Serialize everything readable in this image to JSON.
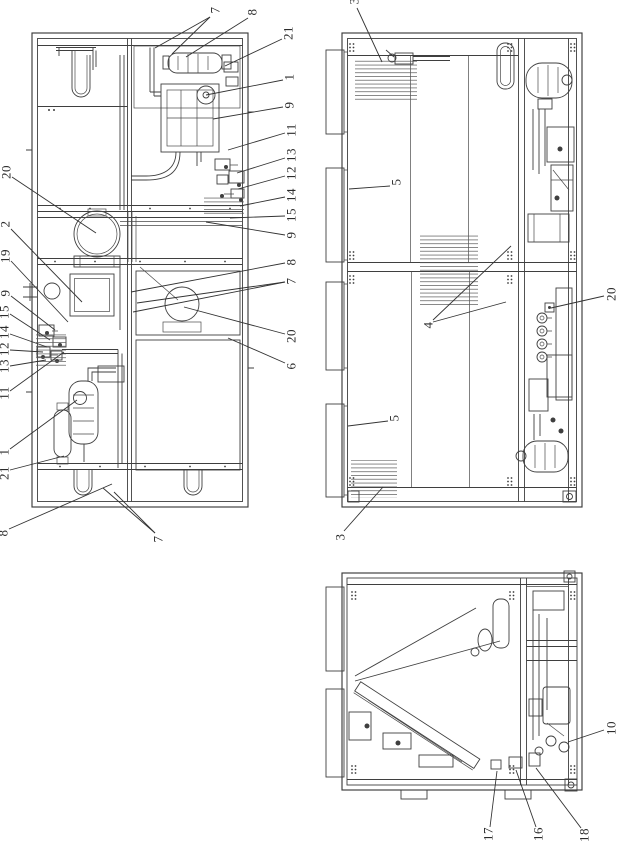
{
  "page": {
    "background": "#ffffff",
    "line_color": "#3f3f3f",
    "leader_color": "#333333",
    "label_color": "#2b2b2b",
    "label_rotation_deg": -90
  },
  "figures": [
    {
      "id": "plan-view",
      "name": "unit-top-plan-view",
      "callouts": [
        {
          "label": "7",
          "x": 215,
          "y": 10,
          "leaders": [
            [
              210,
              17,
              155,
              48
            ],
            [
              210,
              17,
              172,
              54
            ]
          ]
        },
        {
          "label": "8",
          "x": 252,
          "y": 12,
          "leaders": [
            [
              248,
              18,
              186,
              57
            ]
          ]
        },
        {
          "label": "21",
          "x": 288,
          "y": 33,
          "leaders": [
            [
              282,
              39,
              225,
              66
            ]
          ]
        },
        {
          "label": "1",
          "x": 289,
          "y": 77,
          "leaders": [
            [
              283,
              80,
              206,
              95
            ]
          ]
        },
        {
          "label": "9",
          "x": 289,
          "y": 105,
          "leaders": [
            [
              283,
              107,
              213,
              119
            ]
          ]
        },
        {
          "label": "11",
          "x": 291,
          "y": 130,
          "leaders": [
            [
              285,
              133,
              228,
              150
            ]
          ]
        },
        {
          "label": "13",
          "x": 291,
          "y": 155,
          "leaders": [
            [
              285,
              158,
              237,
              173
            ]
          ]
        },
        {
          "label": "12",
          "x": 291,
          "y": 173,
          "leaders": [
            [
              285,
              176,
              238,
              189
            ]
          ]
        },
        {
          "label": "14",
          "x": 291,
          "y": 195,
          "leaders": [
            [
              285,
              197,
              240,
              206
            ]
          ]
        },
        {
          "label": "15",
          "x": 291,
          "y": 215,
          "leaders": [
            [
              285,
              216,
              230,
              218
            ]
          ]
        },
        {
          "label": "9",
          "x": 291,
          "y": 235,
          "leaders": [
            [
              285,
              235,
              206,
              222
            ]
          ]
        },
        {
          "label": "8",
          "x": 291,
          "y": 262,
          "leaders": [
            [
              285,
              263,
              131,
              292
            ]
          ]
        },
        {
          "label": "7",
          "x": 291,
          "y": 281,
          "leaders": [
            [
              285,
              282,
              137,
              303
            ],
            [
              285,
              282,
              133,
              312
            ]
          ]
        },
        {
          "label": "20",
          "x": 291,
          "y": 336,
          "leaders": [
            [
              285,
              334,
              184,
              307
            ]
          ]
        },
        {
          "label": "6",
          "x": 291,
          "y": 366,
          "leaders": [
            [
              285,
              363,
              228,
              338
            ]
          ]
        },
        {
          "label": "20",
          "x": 6,
          "y": 172,
          "leaders": [
            [
              12,
              177,
              96,
              233
            ]
          ]
        },
        {
          "label": "2",
          "x": 5,
          "y": 224,
          "leaders": [
            [
              11,
              229,
              82,
              302
            ]
          ]
        },
        {
          "label": "19",
          "x": 5,
          "y": 256,
          "leaders": [
            [
              11,
              261,
              68,
              322
            ]
          ]
        },
        {
          "label": "9",
          "x": 5,
          "y": 293,
          "leaders": [
            [
              11,
              296,
              55,
              330
            ]
          ]
        },
        {
          "label": "15",
          "x": 4,
          "y": 312,
          "leaders": [
            [
              10,
              314,
              50,
              340
            ]
          ]
        },
        {
          "label": "14",
          "x": 4,
          "y": 332,
          "leaders": [
            [
              10,
              334,
              47,
              347
            ]
          ]
        },
        {
          "label": "12",
          "x": 4,
          "y": 349,
          "leaders": [
            [
              10,
              350,
              43,
              352
            ]
          ]
        },
        {
          "label": "13",
          "x": 4,
          "y": 366,
          "leaders": [
            [
              10,
              366,
              46,
              360
            ]
          ]
        },
        {
          "label": "11",
          "x": 4,
          "y": 393,
          "leaders": [
            [
              10,
              391,
              64,
              352
            ]
          ]
        },
        {
          "label": "1",
          "x": 4,
          "y": 452,
          "leaders": [
            [
              10,
              449,
              77,
              400
            ]
          ]
        },
        {
          "label": "21",
          "x": 4,
          "y": 473,
          "leaders": [
            [
              10,
              470,
              64,
              456
            ]
          ]
        },
        {
          "label": "8",
          "x": 3,
          "y": 533,
          "leaders": [
            [
              9,
              529,
              112,
              484
            ]
          ]
        },
        {
          "label": "7",
          "x": 158,
          "y": 539,
          "leaders": [
            [
              155,
              533,
              103,
              488
            ],
            [
              155,
              533,
              114,
              492
            ]
          ]
        }
      ]
    },
    {
      "id": "front-view",
      "name": "unit-front-view",
      "callouts": [
        {
          "label": "3",
          "x": 354,
          "y": 1,
          "leaders": [
            [
              357,
              8,
              382,
              62
            ]
          ]
        },
        {
          "label": "5",
          "x": 396,
          "y": 182,
          "leaders": [
            [
              390,
              186,
              349,
              189
            ]
          ]
        },
        {
          "label": "4",
          "x": 428,
          "y": 325,
          "leaders": [
            [
              433,
              320,
              511,
              246
            ],
            [
              433,
              322,
              506,
              302
            ]
          ]
        },
        {
          "label": "20",
          "x": 611,
          "y": 294,
          "leaders": [
            [
              604,
              296,
              551,
              308
            ]
          ]
        },
        {
          "label": "5",
          "x": 394,
          "y": 418,
          "leaders": [
            [
              388,
              421,
              348,
              426
            ]
          ]
        },
        {
          "label": "3",
          "x": 340,
          "y": 537,
          "leaders": [
            [
              344,
              531,
              383,
              487
            ]
          ]
        }
      ]
    },
    {
      "id": "side-view",
      "name": "unit-side-view",
      "callouts": [
        {
          "label": "10",
          "x": 611,
          "y": 728,
          "leaders": [
            [
              604,
              730,
              568,
              742
            ]
          ]
        },
        {
          "label": "17",
          "x": 488,
          "y": 834,
          "leaders": [
            [
              490,
              827,
              497,
              771
            ]
          ]
        },
        {
          "label": "16",
          "x": 538,
          "y": 834,
          "leaders": [
            [
              536,
              827,
              516,
              770
            ]
          ]
        },
        {
          "label": "18",
          "x": 584,
          "y": 835,
          "leaders": [
            [
              581,
              828,
              536,
              768
            ]
          ]
        }
      ]
    }
  ]
}
